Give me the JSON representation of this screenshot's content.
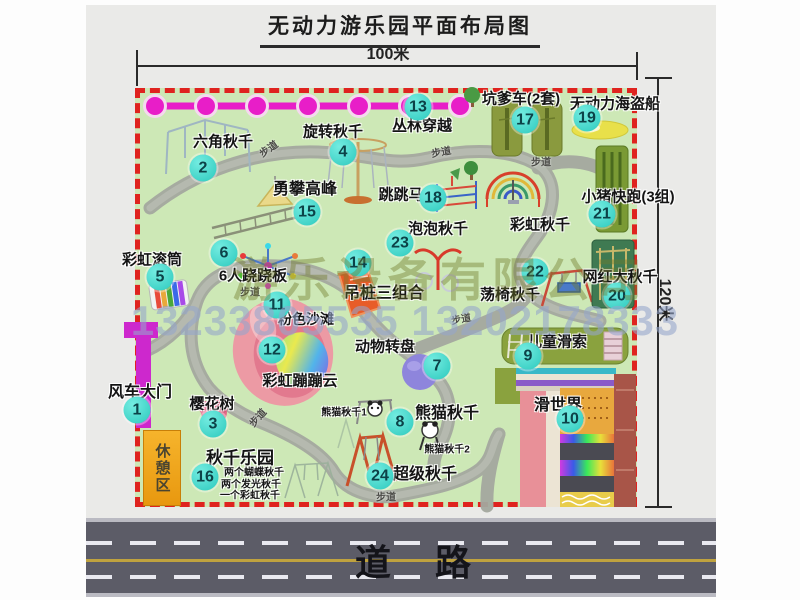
{
  "title": "无动力游乐园平面布局图",
  "dimensions": {
    "width": "100米",
    "height": "120米"
  },
  "road": {
    "label": "道路"
  },
  "rest_area": {
    "label": "休憩区"
  },
  "watermark": {
    "company": "游乐设备有限公司",
    "phone": "13233805535 13202178333"
  },
  "trail_label": "步道",
  "trail_positions": [
    {
      "x": 268,
      "y": 148,
      "rot": -35
    },
    {
      "x": 441,
      "y": 151,
      "rot": -10
    },
    {
      "x": 541,
      "y": 161,
      "rot": 0
    },
    {
      "x": 250,
      "y": 291,
      "rot": 0
    },
    {
      "x": 257,
      "y": 417,
      "rot": -48
    },
    {
      "x": 461,
      "y": 318,
      "rot": -10
    },
    {
      "x": 386,
      "y": 496,
      "rot": 0
    }
  ],
  "markers": [
    {
      "num": "1",
      "label": "风车大门",
      "cx": 137,
      "cy": 410,
      "lx": 140,
      "ly": 390,
      "fs": 16
    },
    {
      "num": "2",
      "label": "六角秋千",
      "cx": 203,
      "cy": 168,
      "lx": 223,
      "ly": 141,
      "fs": 15
    },
    {
      "num": "3",
      "label": "樱花树",
      "cx": 213,
      "cy": 424,
      "lx": 212,
      "ly": 403,
      "fs": 15
    },
    {
      "num": "4",
      "label": "旋转秋千",
      "cx": 343,
      "cy": 152,
      "lx": 333,
      "ly": 131,
      "fs": 15
    },
    {
      "num": "5",
      "label": "彩虹滚筒",
      "cx": 160,
      "cy": 277,
      "lx": 152,
      "ly": 259,
      "fs": 15
    },
    {
      "num": "6",
      "label": "6人跷跷板",
      "cx": 224,
      "cy": 253,
      "lx": 253,
      "ly": 275,
      "fs": 15
    },
    {
      "num": "7",
      "label": "动物转盘",
      "cx": 437,
      "cy": 366,
      "lx": 385,
      "ly": 346,
      "fs": 15
    },
    {
      "num": "8",
      "label": "熊猫秋千",
      "cx": 400,
      "cy": 422,
      "lx": 447,
      "ly": 411,
      "fs": 16
    },
    {
      "num": "9",
      "label": "儿童滑索",
      "cx": 528,
      "cy": 356,
      "lx": 557,
      "ly": 341,
      "fs": 15
    },
    {
      "num": "10",
      "label": "滑世界",
      "cx": 570,
      "cy": 419,
      "lx": 558,
      "ly": 403,
      "fs": 16
    },
    {
      "num": "11",
      "label": "粉色沙滩",
      "cx": 277,
      "cy": 305,
      "lx": 306,
      "ly": 319,
      "fs": 14
    },
    {
      "num": "12",
      "label": "彩虹蹦蹦云",
      "cx": 272,
      "cy": 350,
      "lx": 300,
      "ly": 380,
      "fs": 15
    },
    {
      "num": "13",
      "label": "丛林穿越",
      "cx": 418,
      "cy": 107,
      "lx": 422,
      "ly": 125,
      "fs": 15
    },
    {
      "num": "14",
      "label": "吊桩三组合",
      "cx": 358,
      "cy": 263,
      "lx": 384,
      "ly": 291,
      "fs": 16
    },
    {
      "num": "15",
      "label": "勇攀高峰",
      "cx": 307,
      "cy": 212,
      "lx": 305,
      "ly": 187,
      "fs": 16
    },
    {
      "num": "16",
      "label": "秋千乐园",
      "cx": 205,
      "cy": 477,
      "lx": 240,
      "ly": 456,
      "fs": 17
    },
    {
      "num": "17",
      "label": "坑爹车(2套)",
      "cx": 525,
      "cy": 120,
      "lx": 521,
      "ly": 98,
      "fs": 15
    },
    {
      "num": "18",
      "label": "跳跳马",
      "cx": 433,
      "cy": 198,
      "lx": 401,
      "ly": 194,
      "fs": 15
    },
    {
      "num": "19",
      "label": "无动力海盗船",
      "cx": 587,
      "cy": 118,
      "lx": 615,
      "ly": 103,
      "fs": 15
    },
    {
      "num": "20",
      "label": "网红大秋千",
      "cx": 617,
      "cy": 296,
      "lx": 620,
      "ly": 276,
      "fs": 15
    },
    {
      "num": "21",
      "label": "小猪快跑(3组)",
      "cx": 602,
      "cy": 214,
      "lx": 628,
      "ly": 196,
      "fs": 15
    },
    {
      "num": "22",
      "label": "荡椅秋千",
      "cx": 535,
      "cy": 272,
      "lx": 510,
      "ly": 294,
      "fs": 15
    },
    {
      "num": "23",
      "label": "泡泡秋千",
      "cx": 400,
      "cy": 243,
      "lx": 438,
      "ly": 228,
      "fs": 15
    },
    {
      "num": "24",
      "label": "超级秋千",
      "cx": 380,
      "cy": 476,
      "lx": 425,
      "ly": 472,
      "fs": 16
    }
  ],
  "annotations": [
    {
      "text": "彩虹秋千",
      "x": 540,
      "y": 224,
      "fs": 15
    },
    {
      "text": "熊猫秋千1",
      "x": 344,
      "y": 411,
      "fs": 10
    },
    {
      "text": "熊猫秋千2",
      "x": 447,
      "y": 448,
      "fs": 10
    },
    {
      "text": "两个蝴蝶秋千",
      "x": 254,
      "y": 471,
      "fs": 10
    },
    {
      "text": "两个发光秋千",
      "x": 251,
      "y": 483,
      "fs": 10
    },
    {
      "text": "一个彩虹秋千",
      "x": 250,
      "y": 494,
      "fs": 10
    }
  ],
  "colors": {
    "park_green": "#cde8b6",
    "border_red": "#df231f",
    "marker_teal": "#35d6c9",
    "chain_magenta": "#e81ec8",
    "road_gray": "#5c5c67",
    "gate_magenta": "#cd28cd",
    "rest_orange": "#f0a11c"
  }
}
